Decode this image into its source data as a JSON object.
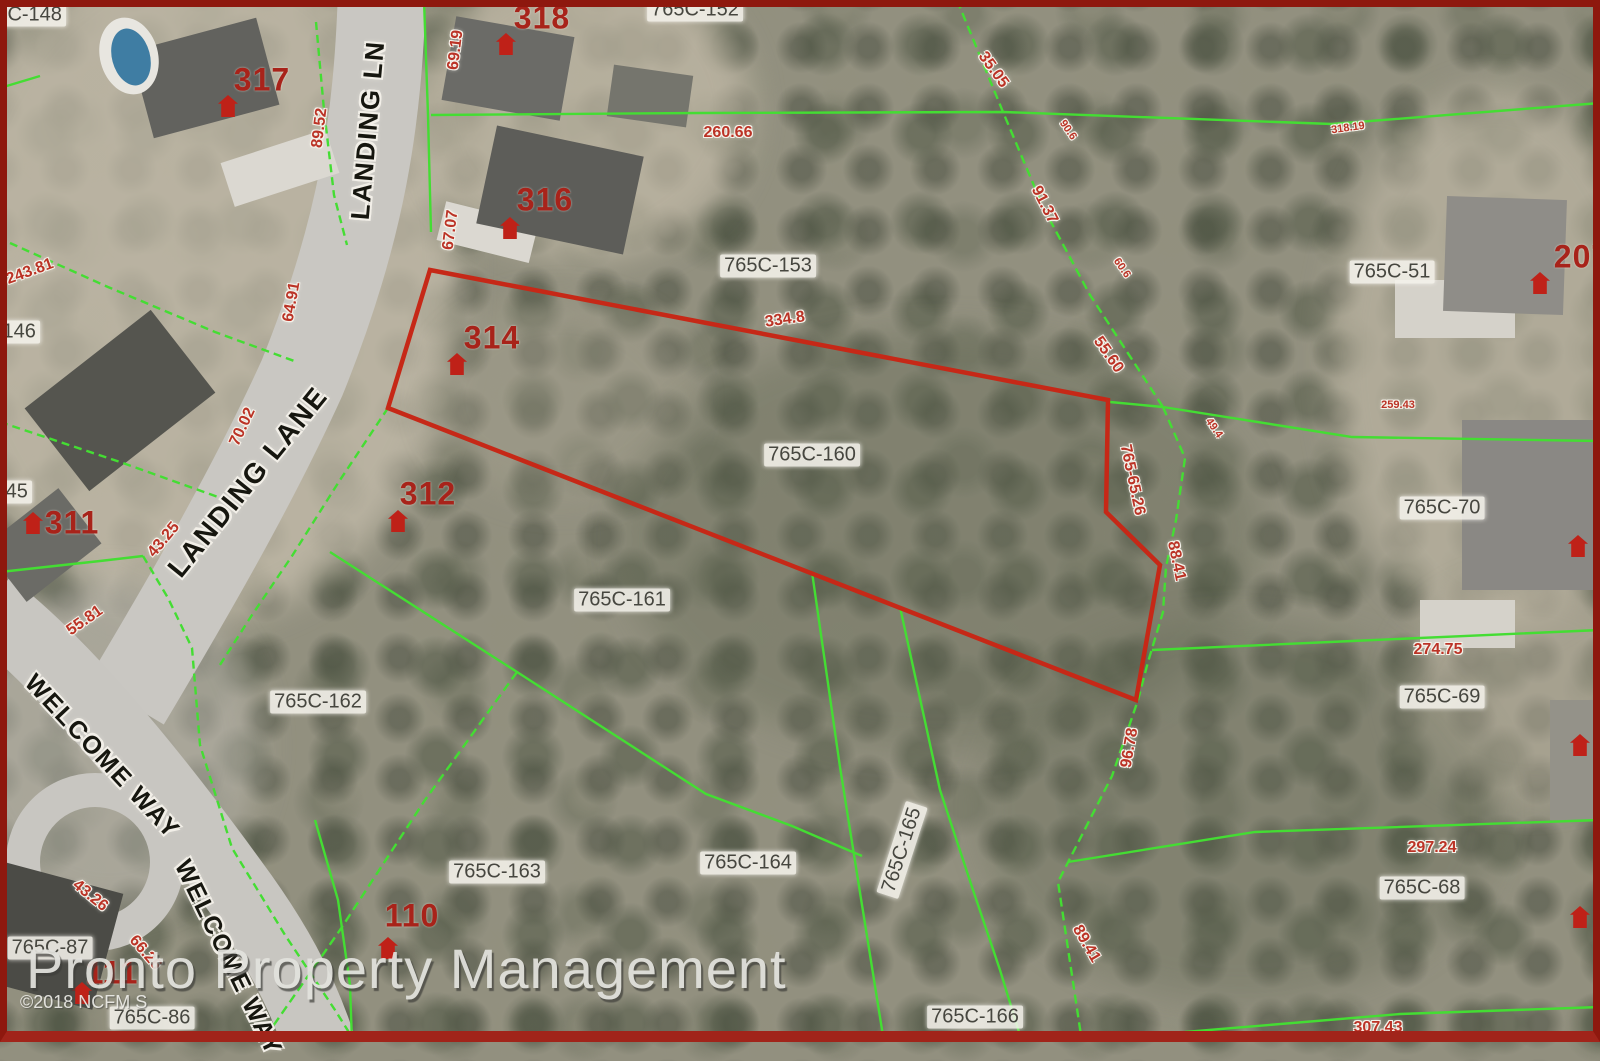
{
  "watermark": {
    "text": "Pronto Property Management"
  },
  "copyright": {
    "text": "©2018 NCFM S"
  },
  "highlighted_parcel": {
    "id": "765C-160",
    "outline_color": "#c62817"
  },
  "colors": {
    "parcel_line_green": "#44dd33",
    "highlight_red": "#c62817",
    "label_red": "#bb3326",
    "address_red": "#a8231a",
    "street_text": "#16160f",
    "border_red": "#8e180e",
    "aerial_base": "#92907f"
  },
  "streets": [
    {
      "text": "LANDING LN"
    },
    {
      "text": "LANDING LANE"
    },
    {
      "text": "WELCOME WAY"
    },
    {
      "text": "WELCOME WAY"
    }
  ],
  "parcels": [
    {
      "text": "765C-148"
    },
    {
      "text": "765C-152"
    },
    {
      "text": "765C-153"
    },
    {
      "text": "765C-146"
    },
    {
      "text": "765C-145"
    },
    {
      "text": "765C-160"
    },
    {
      "text": "765C-161"
    },
    {
      "text": "765C-162"
    },
    {
      "text": "765C-163"
    },
    {
      "text": "765C-164"
    },
    {
      "text": "765C-165"
    },
    {
      "text": "765C-166"
    },
    {
      "text": "765C-51"
    },
    {
      "text": "765C-70"
    },
    {
      "text": "765C-69"
    },
    {
      "text": "765C-68"
    },
    {
      "text": "765C-87"
    },
    {
      "text": "765C-86"
    }
  ],
  "addresses": [
    {
      "text": "317"
    },
    {
      "text": "318"
    },
    {
      "text": "316"
    },
    {
      "text": "314"
    },
    {
      "text": "312"
    },
    {
      "text": "311"
    },
    {
      "text": "110"
    },
    {
      "text": "111"
    },
    {
      "text": "207"
    }
  ],
  "dimensions": [
    {
      "text": "89.52"
    },
    {
      "text": "69.19"
    },
    {
      "text": "67.07"
    },
    {
      "text": "64.91"
    },
    {
      "text": "70.02"
    },
    {
      "text": "43.25"
    },
    {
      "text": "55.81"
    },
    {
      "text": "243.81"
    },
    {
      "text": "260.66"
    },
    {
      "text": "334.8"
    },
    {
      "text": "35.05"
    },
    {
      "text": "91.37"
    },
    {
      "text": "55.60"
    },
    {
      "text": "765-65.26"
    },
    {
      "text": "88.41"
    },
    {
      "text": "96.78"
    },
    {
      "text": "89.41"
    },
    {
      "text": "274.75"
    },
    {
      "text": "297.24"
    },
    {
      "text": "307.43"
    },
    {
      "text": "43.26"
    },
    {
      "text": "66.26"
    },
    {
      "text": "318.19"
    },
    {
      "text": "259.43"
    },
    {
      "text": "90.6"
    },
    {
      "text": "60.6"
    },
    {
      "text": "49.4"
    }
  ]
}
